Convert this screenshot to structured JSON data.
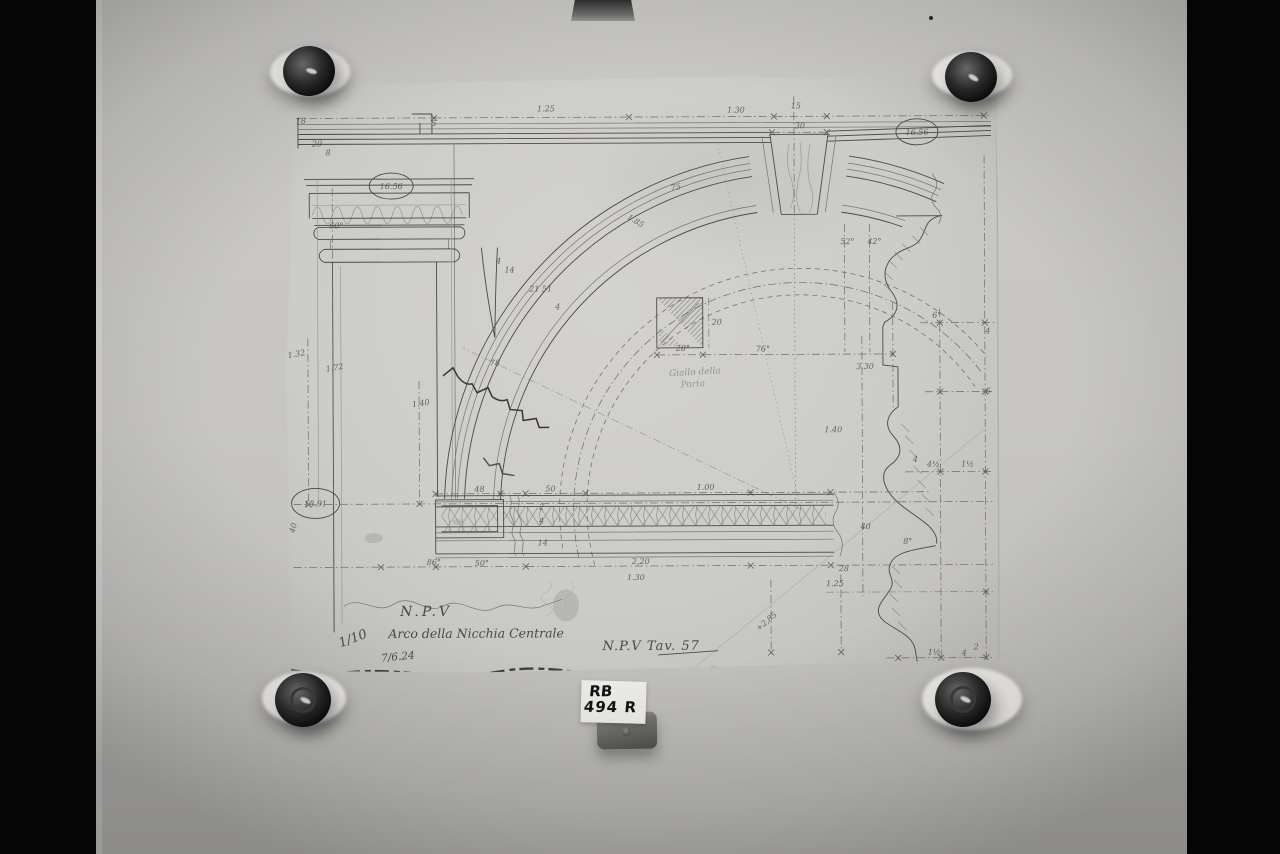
{
  "colors": {
    "backdrop": "#050505",
    "wall": "#c6c5c3",
    "sheet": "#cecdc9",
    "pencil": "#4a4945",
    "tape": "#edebe7",
    "magnet": "#1d1d1d",
    "sticker": "#edece8",
    "sticker_ink": "#121212"
  },
  "archive_label": {
    "line1": "RB",
    "line2": "494 R"
  },
  "drawing": {
    "title_block": {
      "npv": "N.P.V",
      "subject": "Arco della Nicchia Centrale",
      "scale": "1/10",
      "date": "7/6.24",
      "plate": "N.P.V Tav. 57"
    },
    "circled_values": {
      "upper_left": "16.56",
      "upper_right": "16.56",
      "lower_left": "13.91"
    },
    "labels": [
      {
        "x": 262,
        "y": 36,
        "t": "1.25"
      },
      {
        "x": 452,
        "y": 38,
        "t": "1.30"
      },
      {
        "x": 512,
        "y": 34,
        "t": "15",
        "s": 6.5
      },
      {
        "x": 516,
        "y": 54,
        "t": "30",
        "s": 6.5
      },
      {
        "x": 52,
        "y": 152,
        "t": "60°",
        "s": 7.5
      },
      {
        "x": 150,
        "y": 50,
        "t": "5",
        "s": 6
      },
      {
        "x": 17,
        "y": 47,
        "t": "18",
        "s": 6
      },
      {
        "x": 33,
        "y": 70,
        "t": "20",
        "s": 6
      },
      {
        "x": 44,
        "y": 79,
        "t": "8",
        "s": 6
      },
      {
        "x": 563,
        "y": 170,
        "t": "52°",
        "s": 7
      },
      {
        "x": 590,
        "y": 170,
        "t": "42°",
        "s": 7
      },
      {
        "x": 392,
        "y": 115,
        "t": "75",
        "s": 7,
        "r": -10
      },
      {
        "x": 350,
        "y": 148,
        "t": "1.85",
        "s": 7,
        "r": 32
      },
      {
        "x": 214,
        "y": 188,
        "t": "4",
        "s": 5.5
      },
      {
        "x": 225,
        "y": 197,
        "t": "14",
        "s": 5.5
      },
      {
        "x": 256,
        "y": 216,
        "t": "21 51",
        "s": 5.5
      },
      {
        "x": 273,
        "y": 234,
        "t": "4",
        "s": 5.5
      },
      {
        "x": 210,
        "y": 290,
        "t": "78",
        "s": 8
      },
      {
        "x": 398,
        "y": 276,
        "t": "28°",
        "s": 7
      },
      {
        "x": 478,
        "y": 277,
        "t": "76°",
        "s": 8
      },
      {
        "x": 432,
        "y": 250,
        "t": "20",
        "s": 6
      },
      {
        "x": 410,
        "y": 300,
        "t": "Giallo della",
        "s": 9,
        "o": 0.45,
        "c": "hand",
        "r": -3
      },
      {
        "x": 408,
        "y": 312,
        "t": "Porta",
        "s": 9,
        "o": 0.42,
        "c": "hand",
        "r": -3
      },
      {
        "x": 580,
        "y": 295,
        "t": "3.30",
        "s": 8
      },
      {
        "x": 548,
        "y": 358,
        "t": "1.40",
        "s": 8
      },
      {
        "x": 12,
        "y": 280,
        "t": "1.32",
        "s": 8,
        "r": -10
      },
      {
        "x": 50,
        "y": 294,
        "t": "1.72",
        "s": 8,
        "r": -10
      },
      {
        "x": 136,
        "y": 330,
        "t": "1.40",
        "s": 8,
        "r": -8
      },
      {
        "x": 194,
        "y": 416,
        "t": "48",
        "s": 7
      },
      {
        "x": 265,
        "y": 416,
        "t": "50",
        "s": 7
      },
      {
        "x": 420,
        "y": 415,
        "t": "1.00",
        "s": 8
      },
      {
        "x": 355,
        "y": 489,
        "t": "2,20",
        "s": 9
      },
      {
        "x": 196,
        "y": 490,
        "t": "50°",
        "s": 8
      },
      {
        "x": 148,
        "y": 489,
        "t": "86°",
        "s": 8
      },
      {
        "x": 256,
        "y": 434,
        "t": "2",
        "s": 5.5
      },
      {
        "x": 256,
        "y": 448,
        "t": "4",
        "s": 6
      },
      {
        "x": 257,
        "y": 470,
        "t": "14",
        "s": 6
      },
      {
        "x": 580,
        "y": 455,
        "t": "40",
        "s": 7
      },
      {
        "x": 622,
        "y": 470,
        "t": "8°",
        "s": 7
      },
      {
        "x": 549,
        "y": 512,
        "t": "1.25",
        "s": 7
      },
      {
        "x": 558,
        "y": 497,
        "t": "28",
        "s": 5.5,
        "o": 0.6
      },
      {
        "x": 350,
        "y": 505,
        "t": "1.30",
        "s": 8,
        "o": 0.3
      },
      {
        "x": 482,
        "y": 549,
        "t": "+2,85",
        "s": 8,
        "r": -40,
        "o": 0.75
      },
      {
        "x": 652,
        "y": 244,
        "t": "6°",
        "s": 7
      },
      {
        "x": 703,
        "y": 260,
        "t": "4",
        "s": 6
      },
      {
        "x": 703,
        "y": 320,
        "t": "6",
        "s": 6
      },
      {
        "x": 630,
        "y": 388,
        "t": "4",
        "s": 6
      },
      {
        "x": 648,
        "y": 393,
        "t": "4½",
        "s": 7
      },
      {
        "x": 682,
        "y": 393,
        "t": "1½",
        "s": 7
      },
      {
        "x": 648,
        "y": 581,
        "t": "1½",
        "s": 7
      },
      {
        "x": 678,
        "y": 582,
        "t": "4",
        "s": 7
      },
      {
        "x": 690,
        "y": 576,
        "t": "2",
        "s": 5.5
      },
      {
        "x": 10,
        "y": 452,
        "t": "40",
        "s": 6.5,
        "r": -75,
        "o": 0.7
      }
    ]
  }
}
